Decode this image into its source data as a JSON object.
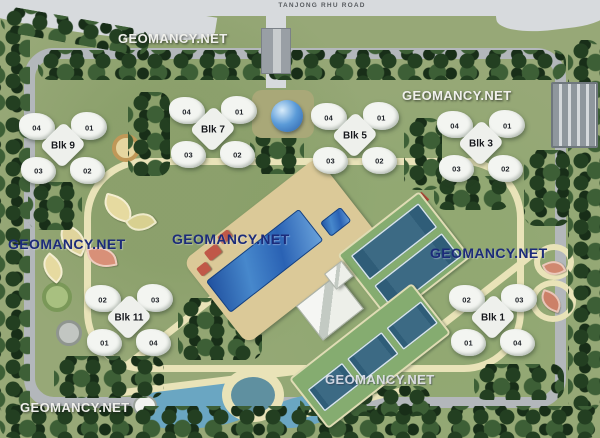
{
  "road": {
    "name": "TANJONG RHU ROAD"
  },
  "watermark": {
    "text": "GEOMANCY.NET"
  },
  "blocks": [
    {
      "name": "Blk 9",
      "units": [
        "04",
        "01",
        "03",
        "02"
      ]
    },
    {
      "name": "Blk 7",
      "units": [
        "04",
        "01",
        "03",
        "02"
      ]
    },
    {
      "name": "Blk 5",
      "units": [
        "04",
        "01",
        "03",
        "02"
      ]
    },
    {
      "name": "Blk 3",
      "units": [
        "04",
        "01",
        "03",
        "02"
      ]
    },
    {
      "name": "Blk 11",
      "units": [
        "02",
        "03",
        "01",
        "04"
      ]
    },
    {
      "name": "Blk 1",
      "units": [
        "02",
        "03",
        "01",
        "04"
      ]
    }
  ],
  "features": [
    "swimming-pool",
    "children-pool",
    "clubhouse",
    "tennis-courts",
    "fountain-dome",
    "pond",
    "gazebo",
    "multi-storey-carpark",
    "entrance-driveway",
    "landscaped-gardens"
  ],
  "palette": {
    "grass": "#97a877",
    "grass-dark": "#829a62",
    "tree": "#24401f",
    "road": "#b3b7bb",
    "road-light": "#d7dadd",
    "path": "#e9e3b8",
    "pool": "#2f6fc4",
    "deck": "#dbc998",
    "court-green": "#85ac70",
    "court-blue": "#3c6a84",
    "building-white": "#f3f5f1",
    "pond": "#6aa6c2",
    "roof-red": "#c05848",
    "watermark-navy": "#1c2b7a",
    "watermark-white": "#f0f0ec"
  }
}
